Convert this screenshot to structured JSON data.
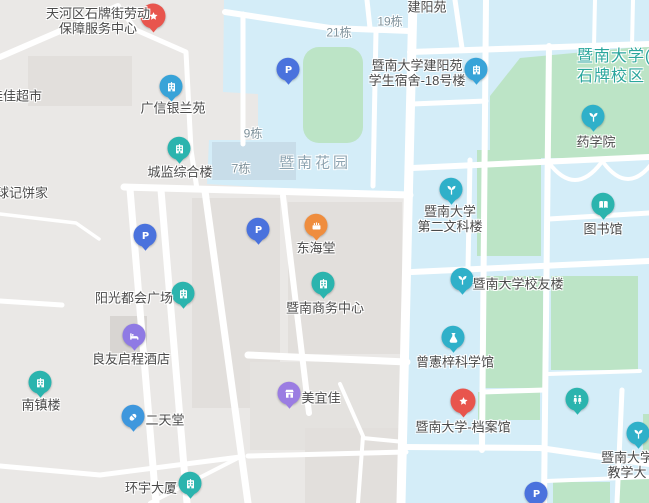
{
  "map": {
    "colors": {
      "city_background": "#eae8e6",
      "campus_area": "#d4edf8",
      "green_area": "#bce4c6",
      "road": "#ffffff",
      "pond": "#c8dde9",
      "parking_blue": "#4a72dd",
      "poi_teal": "#2bb4ae",
      "poi_cyan": "#2fb0c9",
      "poi_blue_building": "#38a3d8",
      "poi_red": "#e8554d",
      "poi_purple_hotel": "#8f7ae4",
      "poi_purple_store": "#9b7de2",
      "poi_blue_pharmacy": "#3e97dd",
      "poi_orange": "#ef8d3e"
    },
    "area_labels": [
      {
        "id": "jiajia-supermarket",
        "text": "佳佳超市",
        "x": 16,
        "y": 96,
        "style": "poi"
      },
      {
        "id": "qiuji-bakery",
        "text": "球记饼家",
        "x": 22,
        "y": 193,
        "style": "poi"
      },
      {
        "id": "building-9",
        "text": "9栋",
        "x": 253,
        "y": 134,
        "style": "area"
      },
      {
        "id": "building-7",
        "text": "7栋",
        "x": 241,
        "y": 169,
        "style": "area"
      },
      {
        "id": "building-21",
        "text": "21栋",
        "x": 339,
        "y": 33,
        "style": "area"
      },
      {
        "id": "building-19",
        "text": "19栋",
        "x": 390,
        "y": 22,
        "style": "area"
      },
      {
        "id": "jianyangyuan",
        "text": "建阳苑",
        "x": 427,
        "y": 7,
        "style": "poi"
      },
      {
        "id": "jinan-garden",
        "text": "暨南花园",
        "x": 315,
        "y": 163,
        "style": "district"
      },
      {
        "id": "jinan-university-campus",
        "text": "暨南大学(\n石牌校区",
        "x": 614,
        "y": 67,
        "style": "campusname"
      }
    ],
    "pois": [
      {
        "id": "labor-service-center",
        "label": "天河区石牌街劳动\n保障服务中心",
        "lx": 98,
        "ly": 21,
        "icon": "star-icon",
        "color": "#e8554d",
        "ix": 153,
        "iy": 19,
        "big": true
      },
      {
        "id": "guangxin-yinlanyuan",
        "label": "广信银兰苑",
        "lx": 173,
        "ly": 108,
        "icon": "building-icon",
        "color": "#38a3d8",
        "ix": 171,
        "iy": 89
      },
      {
        "id": "chengjian-complex",
        "label": "城监综合楼",
        "lx": 180,
        "ly": 172,
        "icon": "building-icon",
        "color": "#2bb4ae",
        "ix": 179,
        "iy": 151
      },
      {
        "id": "jianyangyuan-dorm-18",
        "label": "暨南大学建阳苑\n学生宿舍-18号楼",
        "lx": 417,
        "ly": 73,
        "icon": "building-icon",
        "color": "#38a3d8",
        "ix": 476,
        "iy": 72
      },
      {
        "id": "pharmacy-school",
        "label": "药学院",
        "lx": 596,
        "ly": 142,
        "icon": "sprout-icon",
        "color": "#2fb0c9",
        "ix": 593,
        "iy": 119
      },
      {
        "id": "second-liberal-arts-building",
        "label": "暨南大学\n第二文科楼",
        "lx": 450,
        "ly": 219,
        "icon": "sprout-icon",
        "color": "#2fb0c9",
        "ix": 451,
        "iy": 192
      },
      {
        "id": "library",
        "label": "图书馆",
        "lx": 603,
        "ly": 229,
        "icon": "book-icon",
        "color": "#2bb4ae",
        "ix": 603,
        "iy": 207
      },
      {
        "id": "donghaitang-bakery",
        "label": "东海堂",
        "lx": 316,
        "ly": 248,
        "icon": "cake-icon",
        "color": "#ef8d3e",
        "ix": 316,
        "iy": 228
      },
      {
        "id": "jinan-business-center",
        "label": "暨南商务中心",
        "lx": 325,
        "ly": 308,
        "icon": "building-icon",
        "color": "#2bb4ae",
        "ix": 323,
        "iy": 286
      },
      {
        "id": "sunshine-metro-plaza",
        "label": "阳光都会广场",
        "lx": 134,
        "ly": 298,
        "icon": "building-icon",
        "color": "#2bb4ae",
        "ix": 183,
        "iy": 296
      },
      {
        "id": "liangyou-qicheng-hotel",
        "label": "良友启程酒店",
        "lx": 131,
        "ly": 359,
        "icon": "bed-icon",
        "color": "#8f7ae4",
        "ix": 134,
        "iy": 338
      },
      {
        "id": "alumni-building",
        "label": "暨南大学校友楼",
        "lx": 518,
        "ly": 284,
        "icon": "sprout-icon",
        "color": "#2fb0c9",
        "ix": 462,
        "iy": 282
      },
      {
        "id": "zengxianzi-science-hall",
        "label": "曾憲梓科学馆",
        "lx": 455,
        "ly": 362,
        "icon": "flask-icon",
        "color": "#2fb0c9",
        "ix": 453,
        "iy": 340
      },
      {
        "id": "nanzhenlou",
        "label": "南镇楼",
        "lx": 41,
        "ly": 405,
        "icon": "building-icon",
        "color": "#2bb4ae",
        "ix": 40,
        "iy": 385
      },
      {
        "id": "ertiantang-pharmacy",
        "label": "二天堂",
        "lx": 165,
        "ly": 420,
        "icon": "capsule-icon",
        "color": "#3e97dd",
        "ix": 133,
        "iy": 419
      },
      {
        "id": "meiyijia-store",
        "label": "美宜佳",
        "lx": 321,
        "ly": 398,
        "icon": "store-icon",
        "color": "#9b7de2",
        "ix": 289,
        "iy": 396
      },
      {
        "id": "huanyu-tower",
        "label": "环宇大厦",
        "lx": 151,
        "ly": 488,
        "icon": "building-icon",
        "color": "#2bb4ae",
        "ix": 190,
        "iy": 486
      },
      {
        "id": "jinan-archives",
        "label": "暨南大学-档案馆",
        "lx": 463,
        "ly": 427,
        "icon": "star-icon",
        "color": "#e8554d",
        "ix": 463,
        "iy": 404,
        "big": true
      },
      {
        "id": "restroom",
        "label": "",
        "lx": 0,
        "ly": 0,
        "icon": "restroom-icon",
        "color": "#2bb4ae",
        "ix": 577,
        "iy": 402
      },
      {
        "id": "teaching-building",
        "label": "暨南大学\n教学大",
        "lx": 627,
        "ly": 465,
        "icon": "sprout-icon",
        "color": "#2fb0c9",
        "ix": 638,
        "iy": 436
      }
    ],
    "parking": {
      "glyph": "P",
      "color": "#4a72dd",
      "spots": [
        {
          "x": 288,
          "y": 72
        },
        {
          "x": 145,
          "y": 238
        },
        {
          "x": 258,
          "y": 232
        },
        {
          "x": 536,
          "y": 496
        }
      ]
    }
  }
}
